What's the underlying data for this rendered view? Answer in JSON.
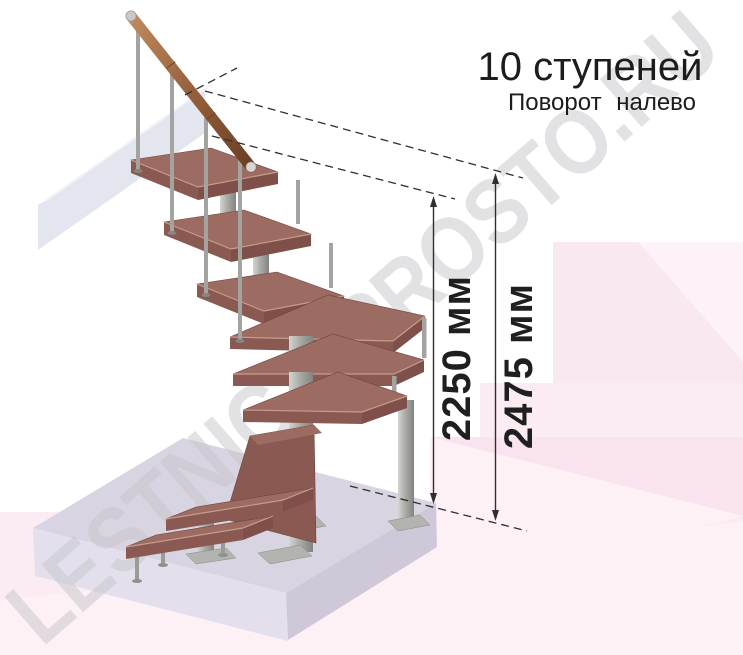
{
  "title": "10 ступеней",
  "subtitle": "Поворот налево",
  "steps_count": "10",
  "turn_direction": "налево",
  "dimensions": {
    "stair_height": "2250 мм",
    "total_height": "2475 мм"
  },
  "watermark": "LESTNICA-PROSTO.RU",
  "colors": {
    "tread_top": "#9c6b62",
    "tread_front": "#8a5a52",
    "handrail_wood": "#96603c",
    "metal": "#aaaaa7",
    "floor_slab": "#d9d4e1",
    "wall_beam": "#e3e6ef",
    "background_pink": "#fae8f1",
    "dimension_ink": "#2f2f2f",
    "watermark_gray": "#c6c6cb"
  }
}
